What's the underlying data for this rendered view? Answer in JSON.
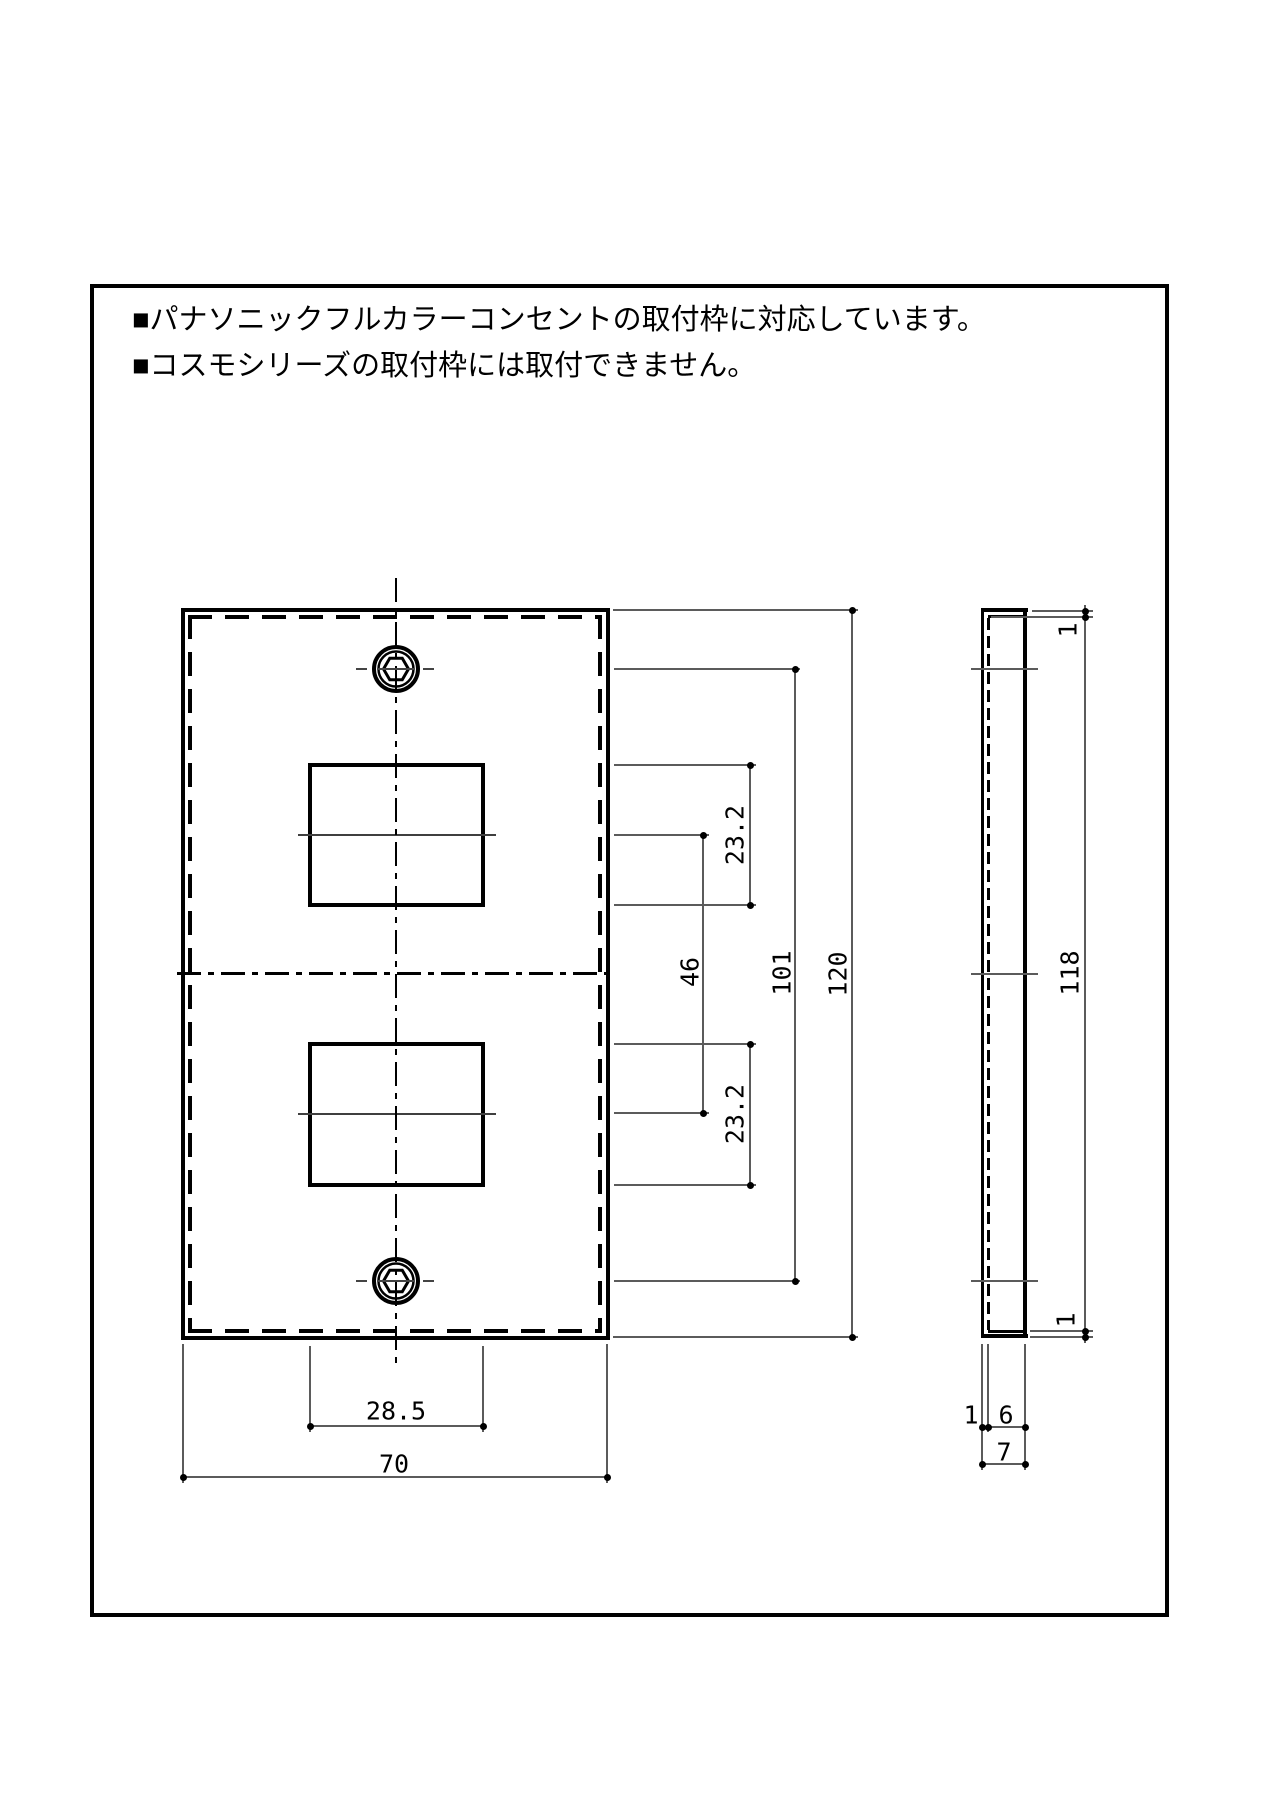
{
  "notes": {
    "line1": "■パナソニックフルカラーコンセントの取付枠に対応しています。",
    "line2": "■コスモシリーズの取付枠には取付できません。"
  },
  "front_view": {
    "opening_height_top": "23.2",
    "opening_center_spacing": "46",
    "screw_hole_spacing": "101",
    "overall_height": "120",
    "opening_height_bottom": "23.2",
    "opening_width": "28.5",
    "overall_width": "70"
  },
  "side_view": {
    "top_thickness": "1",
    "inner_height": "118",
    "bottom_thickness": "1",
    "wall_thickness": "1",
    "inner_depth": "6",
    "overall_depth": "7"
  }
}
